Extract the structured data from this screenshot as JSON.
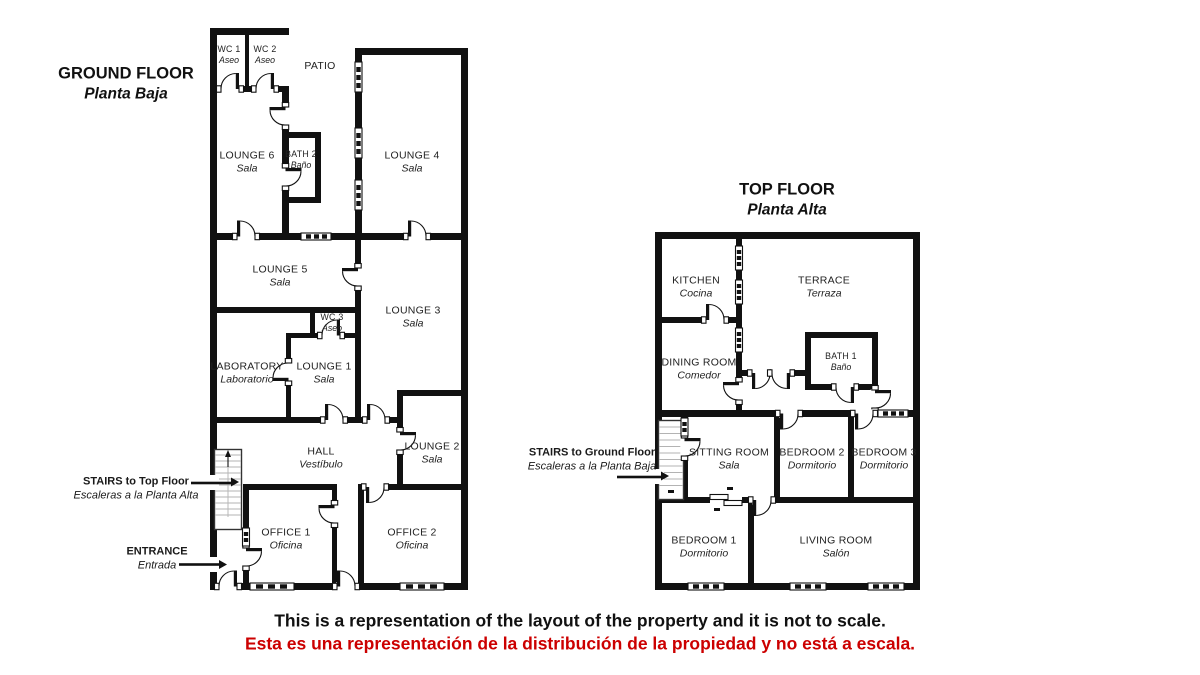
{
  "ground_floor": {
    "title": "GROUND FLOOR",
    "subtitle": "Planta Baja",
    "rooms": {
      "wc1": {
        "name": "WC 1",
        "sub": "Aseo"
      },
      "wc2": {
        "name": "WC 2",
        "sub": "Aseo"
      },
      "patio": {
        "name": "PATIO"
      },
      "lounge6": {
        "name": "LOUNGE 6",
        "sub": "Sala"
      },
      "bath2": {
        "name": "BATH 2",
        "sub": "Baño"
      },
      "lounge4": {
        "name": "LOUNGE 4",
        "sub": "Sala"
      },
      "lounge5": {
        "name": "LOUNGE 5",
        "sub": "Sala"
      },
      "lounge3": {
        "name": "LOUNGE 3",
        "sub": "Sala"
      },
      "wc3": {
        "name": "WC 3",
        "sub": "Aseo"
      },
      "laboratory": {
        "name": "LABORATORY",
        "sub": "Laboratorio"
      },
      "lounge1": {
        "name": "LOUNGE 1",
        "sub": "Sala"
      },
      "hall": {
        "name": "HALL",
        "sub": "Vestíbulo"
      },
      "lounge2": {
        "name": "LOUNGE 2",
        "sub": "Sala"
      },
      "office1": {
        "name": "OFFICE 1",
        "sub": "Oficina"
      },
      "office2": {
        "name": "OFFICE 2",
        "sub": "Oficina"
      }
    },
    "annotations": {
      "stairs": {
        "label": "STAIRS to Top Floor",
        "sub": "Escaleras a la Planta Alta"
      },
      "entrance": {
        "label": "ENTRANCE",
        "sub": "Entrada"
      }
    }
  },
  "top_floor": {
    "title": "TOP FLOOR",
    "subtitle": "Planta Alta",
    "rooms": {
      "kitchen": {
        "name": "KITCHEN",
        "sub": "Cocina"
      },
      "terrace": {
        "name": "TERRACE",
        "sub": "Terraza"
      },
      "dining": {
        "name": "DINING ROOM",
        "sub": "Comedor"
      },
      "bath1": {
        "name": "BATH 1",
        "sub": "Baño"
      },
      "sitting": {
        "name": "SITTING ROOM",
        "sub": "Sala"
      },
      "bedroom2": {
        "name": "BEDROOM 2",
        "sub": "Dormitorio"
      },
      "bedroom3": {
        "name": "BEDROOM 3",
        "sub": "Dormitorio"
      },
      "bedroom1": {
        "name": "BEDROOM 1",
        "sub": "Dormitorio"
      },
      "living": {
        "name": "LIVING ROOM",
        "sub": "Salón"
      }
    },
    "annotations": {
      "stairs": {
        "label": "STAIRS to Ground Floor",
        "sub": "Escaleras a la Planta Baja"
      }
    }
  },
  "disclaimer": {
    "line1_en": "This is a representation of the layout of the property and it is not to scale.",
    "line2_es": "Esta es una representación de la distribución de la propiedad y no está a escala.",
    "line2_color": "#cc0000",
    "wall_color": "#111111"
  }
}
